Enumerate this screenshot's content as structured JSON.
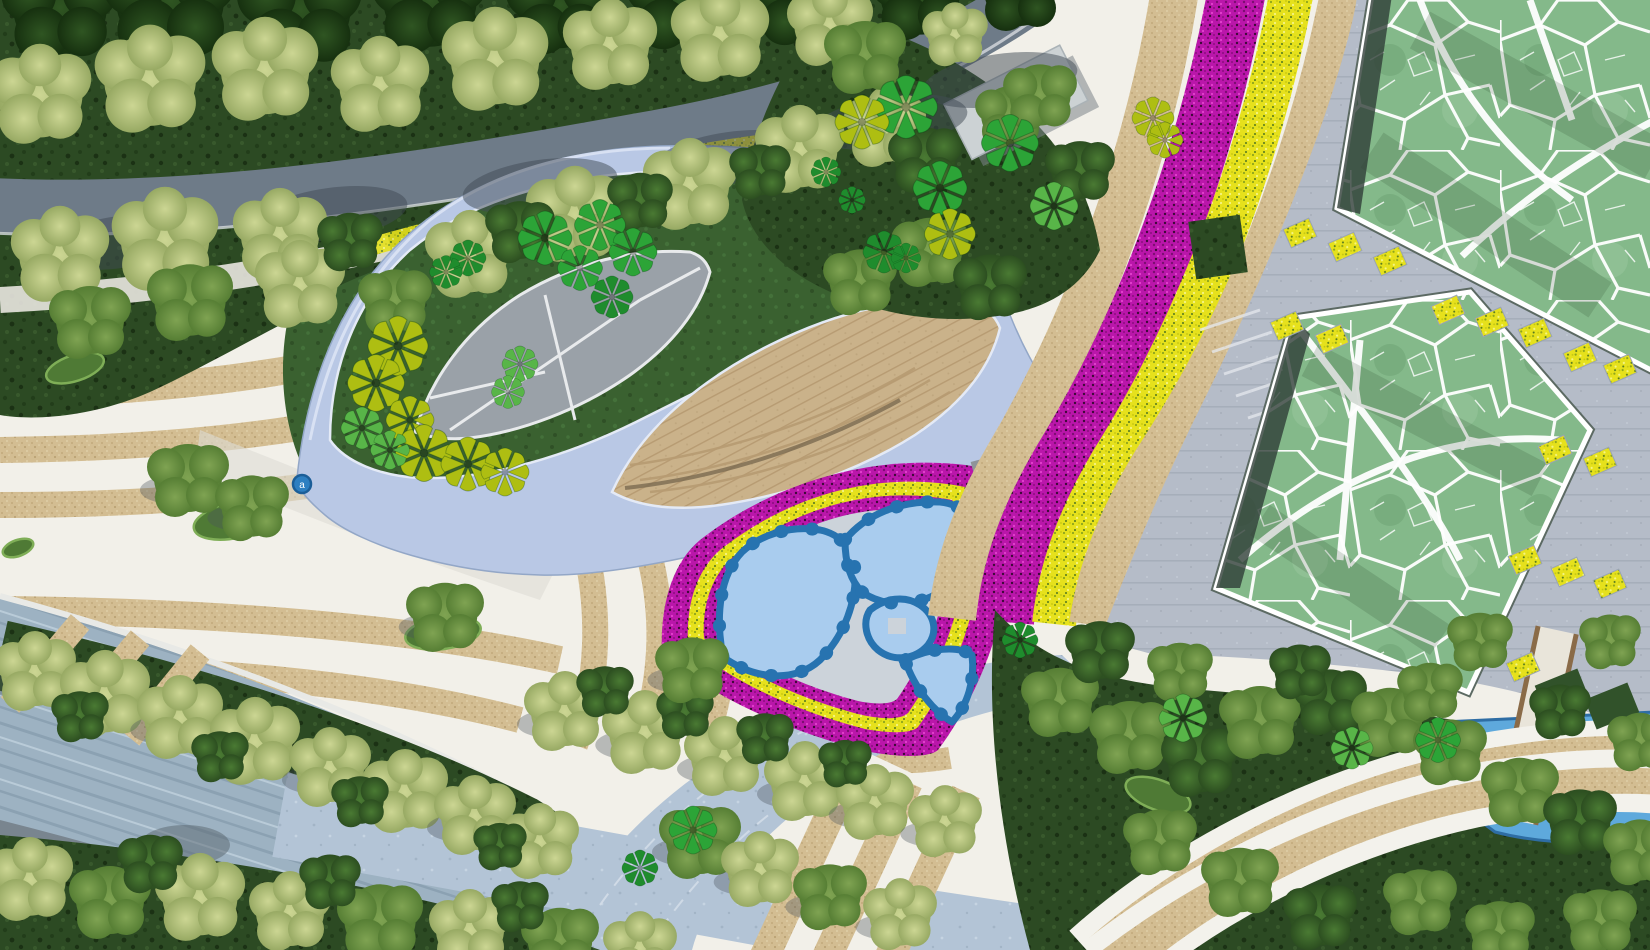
{
  "meta": {
    "title": "Landscape masterplan aerial rendering",
    "type": "park site-plan top view",
    "visible_text": "none"
  },
  "marker": {
    "label": "a",
    "x": 302,
    "y": 484,
    "color": "#2d7fc1",
    "ring": "#1b5e98"
  },
  "palette": {
    "white_paving": "#f2f0e9",
    "sand": "#d3bd92",
    "sand_dot1": "#c3a97c",
    "sand_dot2": "#e2d3ad",
    "magenta_flowers": "#ba16aa",
    "magenta_dark": "#7c0d72",
    "magenta_light": "#e243ce",
    "yellow_flowers": "#e6e11c",
    "yellow_dark": "#8da51c",
    "yellow_light": "#f5f584",
    "ribbon_blue": "#b9c8e5",
    "ribbon_edge": "#93a7c7",
    "ribbon_highlight": "#dbe3f4",
    "lawn_green": "#3a6130",
    "lawn_dot": "#2f5026",
    "forest_green": "#2c4a23",
    "forest_dot": "#223d1a",
    "voronoi_lawn": "#84b98a",
    "voronoi_line": "#ffffff",
    "plaza_gray": "#b5bcc8",
    "plaza_line": "#a6aeba",
    "road_gray": "#6e7b88",
    "road_shadow": "#3f4a54",
    "river_gray": "#9db2c2",
    "river_streak": "#8ba1b2",
    "corner_road_gray": "#79858f",
    "branch_road": "#b3c4d6",
    "lens_tan": "#cab28a",
    "lens_line": "#b79b72",
    "leaf_plaza_gray": "#9aa1a8",
    "pool_blue_light": "#a9ccee",
    "pool_blue_dark": "#2773b0",
    "pool_path_gray": "#ccd3da",
    "water_blue": "#5ea9dc",
    "water_edge": "#2e6da4",
    "building_gray": "#ccd2d4",
    "boardwalk": "#e9e5da",
    "boardwalk_edge": "#8a6b48",
    "hedge_green": "#31522a",
    "shadow_dark": "#2f3d37"
  },
  "pinwheel_colors": {
    "bright": "#2ca437",
    "lime": "#aebe12",
    "deep": "#1f8c2d",
    "green": "#58b548"
  },
  "features": [
    {
      "name": "forest-belt-with-road",
      "color_key": "forest_green"
    },
    {
      "name": "eye-shaped-ribbon-pavilion",
      "color_key": "ribbon_blue"
    },
    {
      "name": "amphitheater-lens",
      "color_key": "lens_tan"
    },
    {
      "name": "leaf-plaza",
      "color_key": "leaf_plaza_gray"
    },
    {
      "name": "triangular-flower-bed-with-pools",
      "color_key": "magenta_flowers"
    },
    {
      "name": "flower-avenue",
      "color_key": "yellow_flowers"
    },
    {
      "name": "voronoi-lawn-north",
      "color_key": "voronoi_lawn"
    },
    {
      "name": "voronoi-lawn-south",
      "color_key": "voronoi_lawn"
    },
    {
      "name": "east-plaza",
      "color_key": "plaza_gray"
    },
    {
      "name": "striped-sand-plaza",
      "color_key": "sand"
    },
    {
      "name": "river-promenade",
      "color_key": "river_gray"
    },
    {
      "name": "southeast-grove",
      "color_key": "forest_green"
    },
    {
      "name": "pond",
      "color_key": "water_blue"
    }
  ],
  "scatter": {
    "fluffy": [
      [
        60,
        8,
        1.3,
        "forest",
        0
      ],
      [
        170,
        0,
        1.5,
        "forest",
        0
      ],
      [
        300,
        10,
        1.4,
        "forest",
        0
      ],
      [
        430,
        0,
        1.3,
        "forest",
        0
      ],
      [
        560,
        5,
        1.2,
        "forest",
        0
      ],
      [
        680,
        0,
        1.2,
        "forest",
        0
      ],
      [
        800,
        0,
        1.1,
        "forest",
        0
      ],
      [
        920,
        -5,
        1.1,
        "forest",
        0
      ],
      [
        1020,
        -10,
        1.0,
        "forest",
        0
      ],
      [
        40,
        95,
        1.25,
        "light",
        0
      ],
      [
        150,
        80,
        1.35,
        "light",
        0
      ],
      [
        265,
        70,
        1.3,
        "light",
        0
      ],
      [
        380,
        85,
        1.2,
        "light",
        0
      ],
      [
        495,
        60,
        1.3,
        "light",
        0
      ],
      [
        610,
        45,
        1.15,
        "light",
        0
      ],
      [
        720,
        35,
        1.2,
        "light",
        0
      ],
      [
        830,
        25,
        1.05,
        "light",
        0
      ],
      [
        60,
        255,
        1.2,
        "light",
        0
      ],
      [
        165,
        240,
        1.3,
        "light",
        0
      ],
      [
        280,
        235,
        1.15,
        "light",
        0
      ],
      [
        90,
        320,
        1.0,
        "mid",
        0
      ],
      [
        190,
        300,
        1.05,
        "mid",
        0
      ],
      [
        300,
        285,
        1.1,
        "light",
        0
      ],
      [
        395,
        300,
        0.9,
        "mid",
        0
      ],
      [
        470,
        255,
        1.1,
        "light",
        0
      ],
      [
        575,
        215,
        1.2,
        "light",
        0
      ],
      [
        690,
        185,
        1.15,
        "light",
        0
      ],
      [
        800,
        150,
        1.1,
        "light",
        0
      ],
      [
        885,
        128,
        1.0,
        "light",
        0
      ],
      [
        955,
        35,
        0.8,
        "light",
        0
      ],
      [
        350,
        240,
        0.8,
        "dark",
        0
      ],
      [
        520,
        230,
        0.85,
        "dark",
        0
      ],
      [
        640,
        200,
        0.8,
        "dark",
        0
      ],
      [
        760,
        170,
        0.75,
        "dark",
        0
      ],
      [
        925,
        158,
        0.9,
        "dark",
        0
      ],
      [
        1010,
        115,
        0.85,
        "mid",
        0
      ],
      [
        865,
        55,
        1.0,
        "mid",
        0
      ],
      [
        1040,
        95,
        0.9,
        "mid",
        0
      ],
      [
        1080,
        170,
        0.85,
        "dark",
        0
      ],
      [
        930,
        250,
        0.95,
        "mid",
        0
      ],
      [
        990,
        285,
        0.9,
        "dark",
        0
      ],
      [
        860,
        280,
        0.9,
        "mid",
        0
      ],
      [
        35,
        672,
        1.0,
        "light",
        1
      ],
      [
        105,
        695,
        1.1,
        "light",
        1
      ],
      [
        180,
        718,
        1.05,
        "light",
        1
      ],
      [
        255,
        742,
        1.1,
        "light",
        1
      ],
      [
        330,
        768,
        1.0,
        "light",
        1
      ],
      [
        405,
        792,
        1.05,
        "light",
        1
      ],
      [
        475,
        816,
        1.0,
        "light",
        1
      ],
      [
        540,
        842,
        0.95,
        "light",
        1
      ],
      [
        80,
        715,
        0.7,
        "dark",
        0
      ],
      [
        220,
        755,
        0.7,
        "dark",
        0
      ],
      [
        360,
        800,
        0.7,
        "dark",
        0
      ],
      [
        500,
        845,
        0.65,
        "dark",
        0
      ],
      [
        30,
        880,
        1.05,
        "light",
        0
      ],
      [
        110,
        900,
        1.0,
        "mid",
        0
      ],
      [
        200,
        898,
        1.1,
        "light",
        0
      ],
      [
        290,
        912,
        1.0,
        "light",
        0
      ],
      [
        380,
        920,
        1.05,
        "mid",
        0
      ],
      [
        470,
        930,
        1.0,
        "light",
        0
      ],
      [
        560,
        940,
        0.95,
        "mid",
        0
      ],
      [
        640,
        948,
        0.9,
        "light",
        0
      ],
      [
        700,
        840,
        1.0,
        "mid",
        1
      ],
      [
        760,
        870,
        0.95,
        "light",
        1
      ],
      [
        830,
        895,
        0.9,
        "mid",
        1
      ],
      [
        900,
        915,
        0.9,
        "light",
        1
      ],
      [
        150,
        862,
        0.8,
        "dark",
        0
      ],
      [
        330,
        880,
        0.75,
        "dark",
        0
      ],
      [
        520,
        905,
        0.7,
        "dark",
        0
      ],
      [
        565,
        712,
        1.0,
        "light",
        1
      ],
      [
        645,
        733,
        1.05,
        "light",
        1
      ],
      [
        725,
        757,
        1.0,
        "light",
        1
      ],
      [
        805,
        782,
        1.0,
        "light",
        1
      ],
      [
        875,
        803,
        0.95,
        "light",
        1
      ],
      [
        945,
        822,
        0.9,
        "light",
        1
      ],
      [
        605,
        690,
        0.7,
        "dark",
        0
      ],
      [
        685,
        712,
        0.7,
        "dark",
        0
      ],
      [
        765,
        737,
        0.7,
        "dark",
        0
      ],
      [
        845,
        762,
        0.65,
        "dark",
        0
      ],
      [
        1060,
        700,
        0.95,
        "mid",
        0
      ],
      [
        1130,
        735,
        1.0,
        "mid",
        0
      ],
      [
        1200,
        760,
        0.95,
        "dark",
        0
      ],
      [
        1260,
        720,
        1.0,
        "mid",
        0
      ],
      [
        1330,
        700,
        0.9,
        "dark",
        0
      ],
      [
        1390,
        720,
        0.95,
        "mid",
        0
      ],
      [
        1450,
        750,
        0.9,
        "mid",
        0
      ],
      [
        1520,
        790,
        0.95,
        "mid",
        0
      ],
      [
        1580,
        820,
        0.9,
        "dark",
        0
      ],
      [
        1640,
        850,
        0.9,
        "mid",
        0
      ],
      [
        1160,
        840,
        0.9,
        "mid",
        0
      ],
      [
        1240,
        880,
        0.95,
        "mid",
        0
      ],
      [
        1320,
        915,
        0.9,
        "dark",
        0
      ],
      [
        1420,
        900,
        0.9,
        "mid",
        0
      ],
      [
        1500,
        930,
        0.85,
        "mid",
        0
      ],
      [
        1600,
        920,
        0.9,
        "mid",
        0
      ],
      [
        1100,
        650,
        0.85,
        "dark",
        0
      ],
      [
        1180,
        670,
        0.8,
        "mid",
        0
      ],
      [
        1300,
        670,
        0.75,
        "dark",
        0
      ],
      [
        1430,
        690,
        0.8,
        "mid",
        0
      ],
      [
        1560,
        710,
        0.75,
        "dark",
        0
      ],
      [
        1640,
        740,
        0.8,
        "mid",
        0
      ],
      [
        1480,
        640,
        0.8,
        "mid",
        0
      ],
      [
        1610,
        640,
        0.75,
        "mid",
        0
      ],
      [
        188,
        478,
        1.0,
        "mid",
        1
      ],
      [
        252,
        506,
        0.9,
        "mid",
        1
      ],
      [
        445,
        615,
        0.95,
        "mid",
        1
      ],
      [
        692,
        668,
        0.9,
        "mid",
        1
      ]
    ],
    "pinwheels": [
      [
        545,
        238,
        0.9,
        "bright"
      ],
      [
        600,
        225,
        0.85,
        "bright"
      ],
      [
        633,
        252,
        0.8,
        "bright"
      ],
      [
        580,
        268,
        0.75,
        "bright"
      ],
      [
        612,
        297,
        0.7,
        "deep"
      ],
      [
        468,
        258,
        0.6,
        "deep"
      ],
      [
        446,
        272,
        0.55,
        "deep"
      ],
      [
        398,
        346,
        1.0,
        "lime"
      ],
      [
        376,
        383,
        0.95,
        "lime"
      ],
      [
        410,
        420,
        0.8,
        "lime"
      ],
      [
        424,
        453,
        0.95,
        "lime"
      ],
      [
        468,
        464,
        0.9,
        "lime"
      ],
      [
        505,
        472,
        0.8,
        "lime"
      ],
      [
        362,
        428,
        0.7,
        "green"
      ],
      [
        390,
        450,
        0.65,
        "green"
      ],
      [
        520,
        364,
        0.6,
        "green"
      ],
      [
        508,
        392,
        0.55,
        "green"
      ],
      [
        906,
        107,
        1.05,
        "bright"
      ],
      [
        1010,
        143,
        0.95,
        "bright"
      ],
      [
        940,
        188,
        0.9,
        "bright"
      ],
      [
        1054,
        206,
        0.8,
        "green"
      ],
      [
        862,
        122,
        0.9,
        "lime"
      ],
      [
        950,
        234,
        0.85,
        "lime"
      ],
      [
        884,
        252,
        0.7,
        "deep"
      ],
      [
        826,
        172,
        0.5,
        "deep"
      ],
      [
        852,
        200,
        0.45,
        "deep"
      ],
      [
        906,
        258,
        0.5,
        "deep"
      ],
      [
        1153,
        118,
        0.7,
        "lime"
      ],
      [
        1165,
        140,
        0.6,
        "lime"
      ],
      [
        1183,
        718,
        0.8,
        "green"
      ],
      [
        1352,
        748,
        0.7,
        "green"
      ],
      [
        1438,
        740,
        0.75,
        "bright"
      ],
      [
        693,
        830,
        0.8,
        "bright"
      ],
      [
        640,
        868,
        0.6,
        "deep"
      ],
      [
        1020,
        640,
        0.6,
        "deep"
      ]
    ],
    "shrub_ovals": [
      [
        75,
        368,
        30,
        13,
        -18
      ],
      [
        235,
        520,
        42,
        18,
        -12
      ],
      [
        443,
        633,
        38,
        16,
        -8
      ],
      [
        18,
        548,
        16,
        8,
        -20
      ],
      [
        1158,
        795,
        34,
        15,
        20
      ]
    ],
    "planters_yellow": [
      [
        1300,
        233
      ],
      [
        1345,
        247
      ],
      [
        1390,
        261
      ],
      [
        1448,
        310
      ],
      [
        1492,
        322
      ],
      [
        1535,
        333
      ],
      [
        1287,
        326
      ],
      [
        1332,
        339
      ],
      [
        1580,
        357
      ],
      [
        1620,
        369
      ],
      [
        1555,
        450
      ],
      [
        1600,
        462
      ],
      [
        1525,
        560
      ],
      [
        1568,
        572
      ],
      [
        1610,
        584
      ],
      [
        1480,
        655
      ],
      [
        1523,
        667
      ]
    ],
    "hedges": [
      [
        1562,
        692
      ],
      [
        1612,
        706
      ]
    ],
    "road_shadows": [
      [
        120,
        242
      ],
      [
        330,
        214
      ],
      [
        540,
        186
      ],
      [
        730,
        158
      ],
      [
        890,
        122
      ],
      [
        1000,
        80
      ]
    ]
  }
}
